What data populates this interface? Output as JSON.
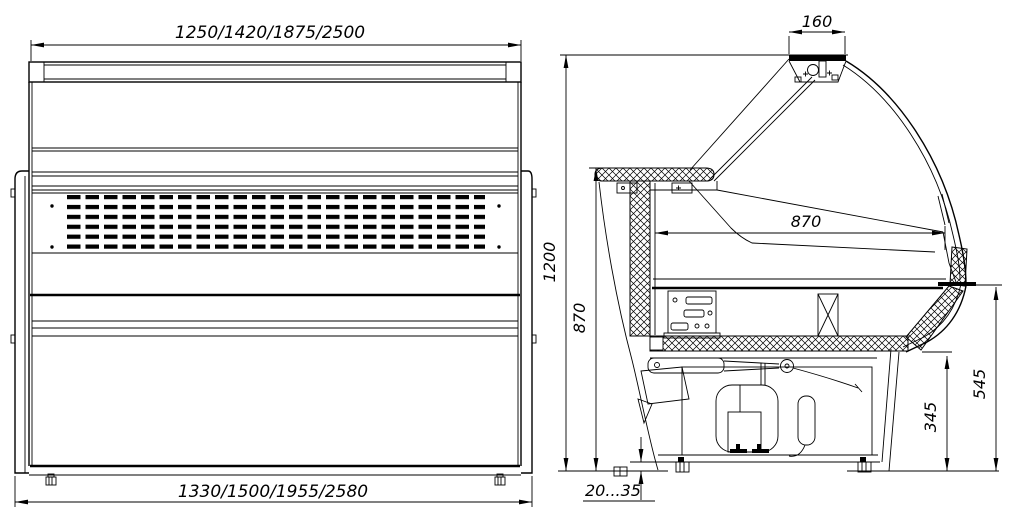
{
  "drawing": {
    "type": "technical-drawing",
    "subject": "refrigerated-display-case",
    "colors": {
      "line": "#000000",
      "background": "#ffffff"
    },
    "front_view": {
      "dim_top_width": "1250/1420/1875/2500",
      "dim_bottom_width": "1330/1500/1955/2580"
    },
    "side_view": {
      "dim_canopy_width": "160",
      "dim_total_height": "1200",
      "dim_counter_height": "870",
      "dim_display_depth": "870",
      "dim_front_shelf_height": "545",
      "dim_bumper_height": "345",
      "dim_leg_adjust_range": "20...35"
    }
  }
}
